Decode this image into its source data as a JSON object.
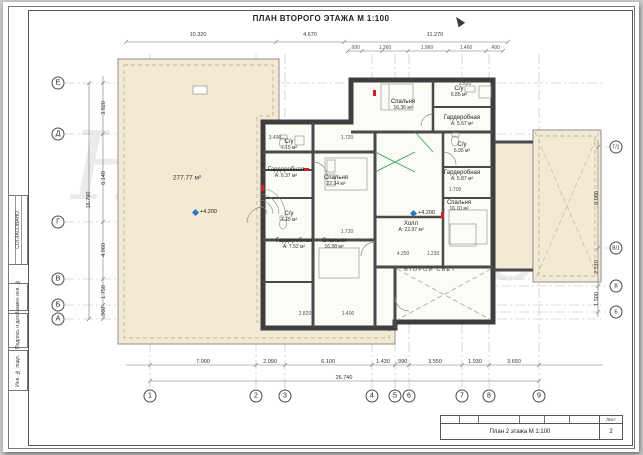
{
  "sheet": {
    "title": "ПЛАН ВТОРОГО ЭТАЖА М 1:100",
    "watermark": "Hauses",
    "side_labels": [
      {
        "label": "СОГЛАСОВАНО"
      },
      {
        "label": "Взамен инв. №"
      },
      {
        "label": "Подпись и дата"
      },
      {
        "label": "Инв. № подл."
      }
    ],
    "stamp": {
      "drawing_name": "План 2 этажа М 1:100",
      "sheet_header": "Лист",
      "sheet_number": "2"
    }
  },
  "colors": {
    "terrace_fill": "#f4e9d2",
    "wall": "#3e3e3e",
    "level_marker": "#2b7bc4",
    "accent_green": "#2e9e4f",
    "accent_red": "#cc2222"
  },
  "plan": {
    "terrace_area": {
      "value": "277.77 м²",
      "x": 184,
      "y": 176
    },
    "second_light_label": {
      "value": "ВТОРОЙ СВЕТ",
      "x": 427,
      "y": 268
    },
    "rooms": [
      {
        "name": "Спальня",
        "area": "16.36 м²",
        "x": 400,
        "y": 103
      },
      {
        "name": "С/у",
        "area": "6.85 м²",
        "x": 456,
        "y": 90
      },
      {
        "name": "Гардеробная",
        "area": "А: 5.67 м²",
        "x": 459,
        "y": 119
      },
      {
        "name": "С/у",
        "area": "7.15 м²",
        "x": 286,
        "y": 143
      },
      {
        "name": "Гардеробная",
        "area": "А: 6.37 м²",
        "x": 283,
        "y": 171
      },
      {
        "name": "Спальня",
        "area": "22.34 м²",
        "x": 333,
        "y": 179
      },
      {
        "name": "С/у",
        "area": "7.15 м²",
        "x": 286,
        "y": 215
      },
      {
        "name": "С/у",
        "area": "6.95 м²",
        "x": 459,
        "y": 146
      },
      {
        "name": "Гардеробная",
        "area": "А: 5.87 м²",
        "x": 459,
        "y": 174
      },
      {
        "name": "Спальня",
        "area": "16.10 м²",
        "x": 456,
        "y": 204
      },
      {
        "name": "Гардеробная",
        "area": "А: 7.52 м²",
        "x": 291,
        "y": 242
      },
      {
        "name": "Спальня",
        "area": "16.08 м²",
        "x": 331,
        "y": 242
      },
      {
        "name": "Холл",
        "area": "А: 22.97 м²",
        "x": 408,
        "y": 225
      }
    ],
    "levels": [
      {
        "value": "+4.200",
        "x": 190,
        "y": 210
      },
      {
        "value": "+4.200",
        "x": 408,
        "y": 211
      }
    ]
  },
  "axes": {
    "bottom": [
      {
        "label": "1",
        "x": 147,
        "y": 394
      },
      {
        "label": "2",
        "x": 253,
        "y": 394
      },
      {
        "label": "3",
        "x": 282,
        "y": 394
      },
      {
        "label": "4",
        "x": 369,
        "y": 394
      },
      {
        "label": "5",
        "x": 392,
        "y": 394
      },
      {
        "label": "6",
        "x": 406,
        "y": 394
      },
      {
        "label": "7",
        "x": 459,
        "y": 394
      },
      {
        "label": "8",
        "x": 486,
        "y": 394
      },
      {
        "label": "9",
        "x": 536,
        "y": 394
      }
    ],
    "left": [
      {
        "label": "Е",
        "x": 55,
        "y": 81
      },
      {
        "label": "Д",
        "x": 55,
        "y": 132
      },
      {
        "label": "Г",
        "x": 55,
        "y": 220
      },
      {
        "label": "В",
        "x": 55,
        "y": 277
      },
      {
        "label": "Б",
        "x": 55,
        "y": 303
      },
      {
        "label": "А",
        "x": 55,
        "y": 317
      }
    ],
    "right": [
      {
        "label": "Г/1",
        "x": 613,
        "y": 145
      },
      {
        "label": "В/1",
        "x": 613,
        "y": 246
      },
      {
        "label": "В",
        "x": 613,
        "y": 284
      },
      {
        "label": "Б",
        "x": 613,
        "y": 310
      }
    ]
  },
  "dims": {
    "top": [
      {
        "v": "10.320",
        "x": 195,
        "y": 33
      },
      {
        "v": "4.670",
        "x": 307,
        "y": 33
      },
      {
        "v": "11.270",
        "x": 432,
        "y": 33
      }
    ],
    "top_small": [
      {
        "v": ".690",
        "x": 352,
        "y": 46
      },
      {
        "v": "1.360",
        "x": 382,
        "y": 46
      },
      {
        "v": "1.960",
        "x": 424,
        "y": 46
      },
      {
        "v": "1.460",
        "x": 463,
        "y": 46
      },
      {
        "v": ".490",
        "x": 492,
        "y": 46
      }
    ],
    "bottom": [
      {
        "v": "7.000",
        "x": 200,
        "y": 360
      },
      {
        "v": "2.090",
        "x": 267,
        "y": 360
      },
      {
        "v": "6.100",
        "x": 325,
        "y": 360
      },
      {
        "v": "1.430",
        "x": 380,
        "y": 360
      },
      {
        "v": ".990",
        "x": 399,
        "y": 360
      },
      {
        "v": "3.550",
        "x": 432,
        "y": 360
      },
      {
        "v": "1.930",
        "x": 472,
        "y": 360
      },
      {
        "v": "3.650",
        "x": 511,
        "y": 360
      }
    ],
    "bottom_total": {
      "v": "26.740",
      "x": 341,
      "y": 376
    },
    "left": [
      {
        "v": "3.820",
        "x": 101,
        "y": 106
      },
      {
        "v": "6.140",
        "x": 101,
        "y": 176
      },
      {
        "v": "4.960",
        "x": 101,
        "y": 248
      },
      {
        "v": "1.750",
        "x": 101,
        "y": 290
      },
      {
        "v": ".960",
        "x": 101,
        "y": 310
      },
      {
        "v": "16.790",
        "x": 86,
        "y": 198
      }
    ],
    "right": [
      {
        "v": "6.060",
        "x": 594,
        "y": 196
      },
      {
        "v": "2.510",
        "x": 594,
        "y": 265
      },
      {
        "v": "1.500",
        "x": 594,
        "y": 297
      }
    ],
    "interior": [
      {
        "v": "3.490",
        "x": 272,
        "y": 136
      },
      {
        "v": "1.720",
        "x": 344,
        "y": 136
      },
      {
        "v": "2.520",
        "x": 462,
        "y": 82
      },
      {
        "v": "1.700",
        "x": 452,
        "y": 188
      },
      {
        "v": "1.720",
        "x": 344,
        "y": 230
      },
      {
        "v": "2.820",
        "x": 302,
        "y": 312
      },
      {
        "v": "1.400",
        "x": 345,
        "y": 312
      },
      {
        "v": "4.250",
        "x": 400,
        "y": 252
      },
      {
        "v": "1.230",
        "x": 430,
        "y": 252
      }
    ]
  }
}
